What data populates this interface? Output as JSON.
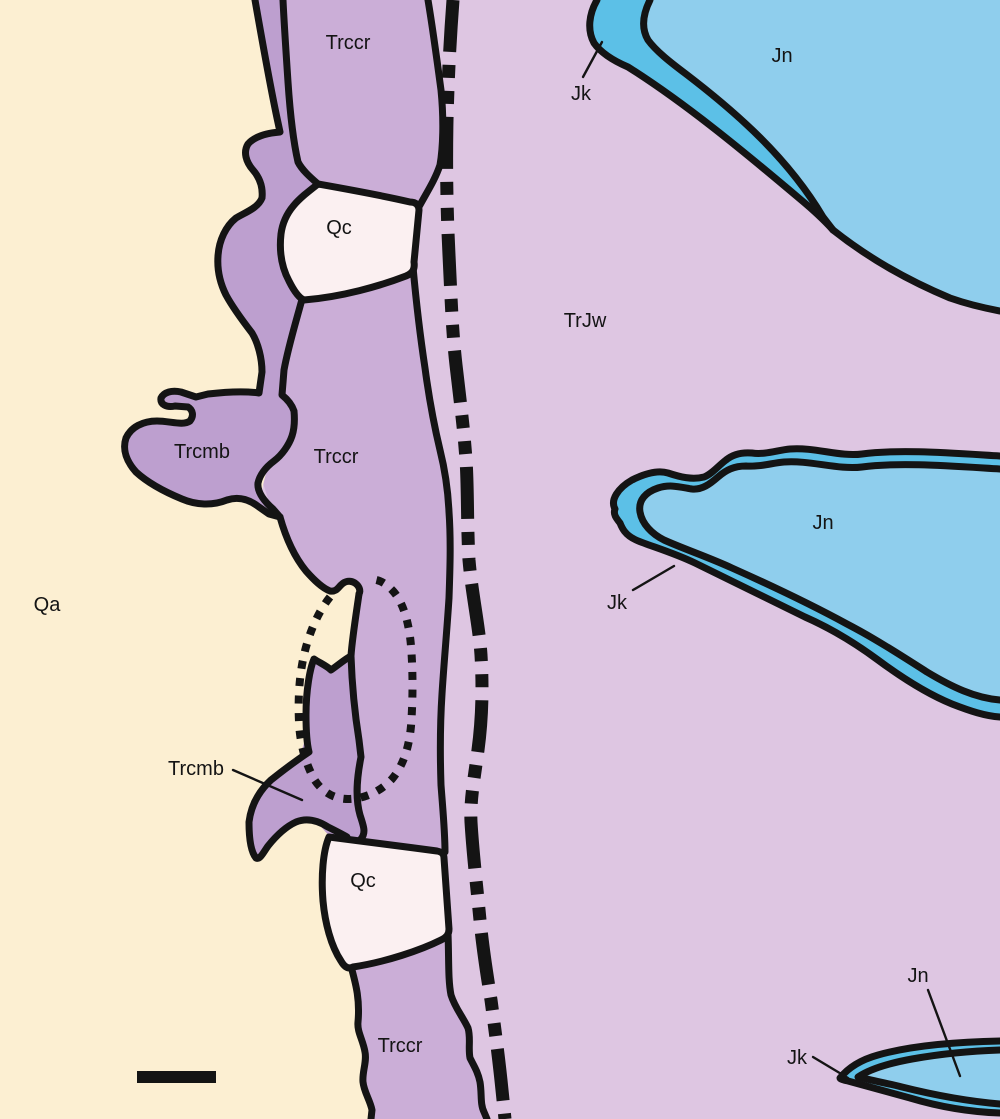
{
  "map": {
    "units": [
      {
        "code": "Qa",
        "color": "#fcefd2"
      },
      {
        "code": "Qc",
        "color": "#fbf0f1"
      },
      {
        "code": "Trcmb",
        "color": "#bd9fcf"
      },
      {
        "code": "Trccr",
        "color": "#cbaed7"
      },
      {
        "code": "TrJw",
        "color": "#dec6e2"
      },
      {
        "code": "Jk",
        "color": "#5cc0e7"
      },
      {
        "code": "Jn",
        "color": "#8fceed"
      }
    ],
    "line_color": "#141414",
    "labels": [
      {
        "text": "Trccr"
      },
      {
        "text": "Jn"
      },
      {
        "text": "Jk"
      },
      {
        "text": "Qc"
      },
      {
        "text": "TrJw"
      },
      {
        "text": "Trcmb"
      },
      {
        "text": "Trccr"
      },
      {
        "text": "Qa"
      },
      {
        "text": "Jn"
      },
      {
        "text": "Jk"
      },
      {
        "text": "Trcmb"
      },
      {
        "text": "Qc"
      },
      {
        "text": "Jn"
      },
      {
        "text": "Jk"
      },
      {
        "text": "Trccr"
      }
    ],
    "scale_bar": {
      "present": true
    }
  }
}
